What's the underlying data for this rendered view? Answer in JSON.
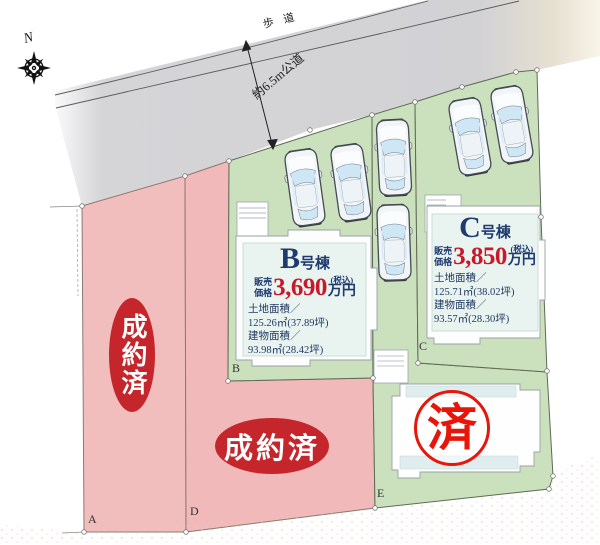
{
  "compass": {
    "north_label": "N"
  },
  "road": {
    "sidewalk_label": "歩道",
    "width_label": "約6.5m公道"
  },
  "lots": {
    "a": {
      "corner_label": "A",
      "status": "成約済"
    },
    "d": {
      "corner_label": "D",
      "status": "成約済"
    },
    "e": {
      "corner_label": "E",
      "stamp": "済"
    },
    "b": {
      "corner_label": "B",
      "building": {
        "letter": "B",
        "suffix": "号棟",
        "price_label_1": "販売",
        "price_label_2": "価格",
        "price_value": "3,690",
        "tax_note": "(税込)",
        "unit": "万円",
        "land_label": "土地面積／",
        "land_value": "125.26㎡(37.89坪)",
        "bldg_label": "建物面積／",
        "bldg_value": "93.98㎡(28.42坪)"
      }
    },
    "c": {
      "corner_label": "C",
      "building": {
        "letter": "C",
        "suffix": "号棟",
        "price_label_1": "販売",
        "price_label_2": "価格",
        "price_value": "3,850",
        "tax_note": "(税込)",
        "unit": "万円",
        "land_label": "土地面積／",
        "land_value": "125.71㎡(38.02坪)",
        "bldg_label": "建物面積／",
        "bldg_value": "93.57㎡(28.30坪)"
      }
    }
  },
  "car_count": 6,
  "colors": {
    "available_green": "#cbe0bc",
    "sold_pink": "#f2bdbd",
    "road_gray": "#d3d3d6",
    "sold_badge_red": "#c5262c",
    "stamp_red": "#e8150a",
    "price_red": "#c9182a",
    "info_navy": "#1e3a6e"
  }
}
